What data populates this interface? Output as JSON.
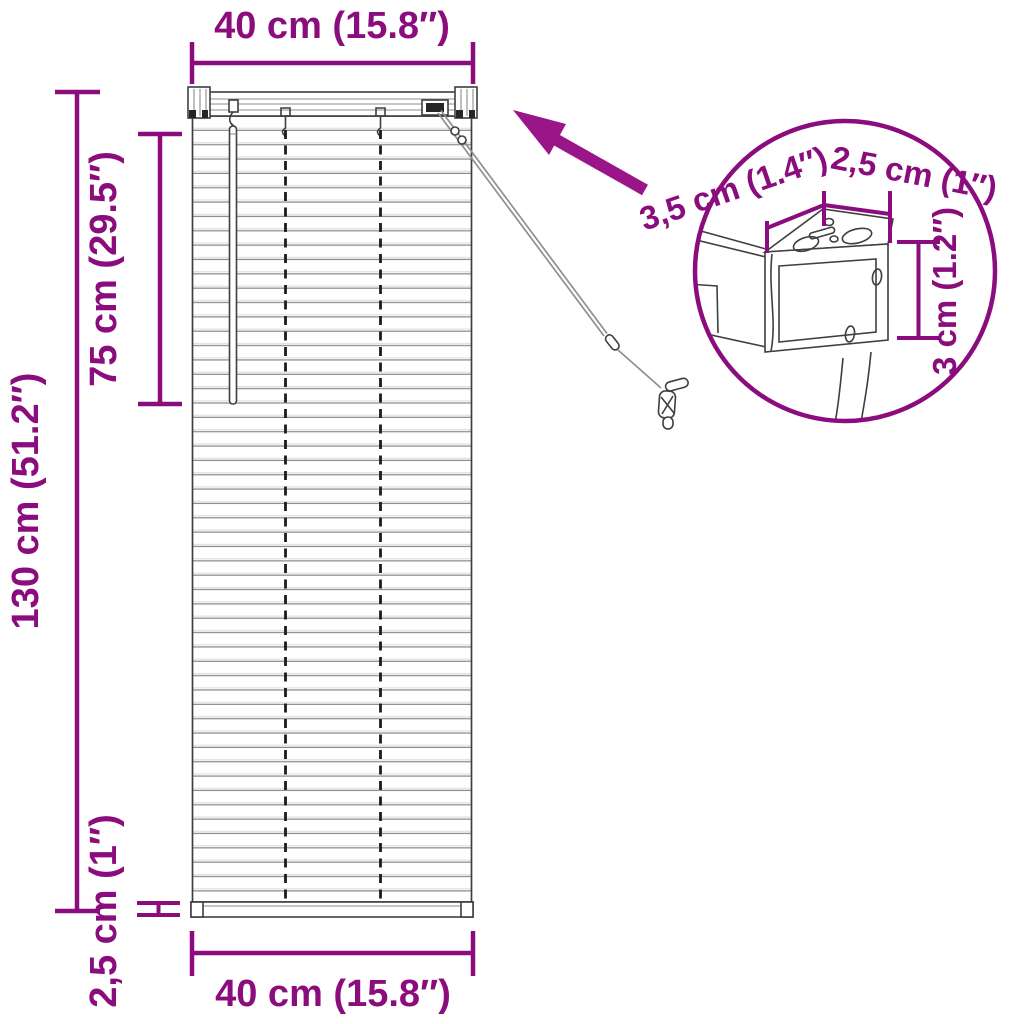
{
  "page": {
    "background": "#ffffff",
    "description": "Product dimension diagram of a venetian blind (40 x 130 cm) with a magnified wall-bracket detail inset"
  },
  "colors": {
    "accent": "#8B0D7D",
    "arrow": "#9A1588",
    "outline": "#3f3f3f",
    "slat_line": "#8a8a8a"
  },
  "main_figure": {
    "dimensions": {
      "top_width": "40 cm (15.8″)",
      "total_height": "130 cm (51.2″)",
      "wand_length": "75 cm (29.5″)",
      "bottom_rail_height": "2,5 cm (1″)",
      "bottom_width": "40 cm (15.8″)"
    }
  },
  "detail_inset": {
    "bracket_depth": "3,5 cm (1.4″)",
    "bracket_width": "2,5 cm (1″)",
    "bracket_height": "3 cm (1.2″)"
  }
}
